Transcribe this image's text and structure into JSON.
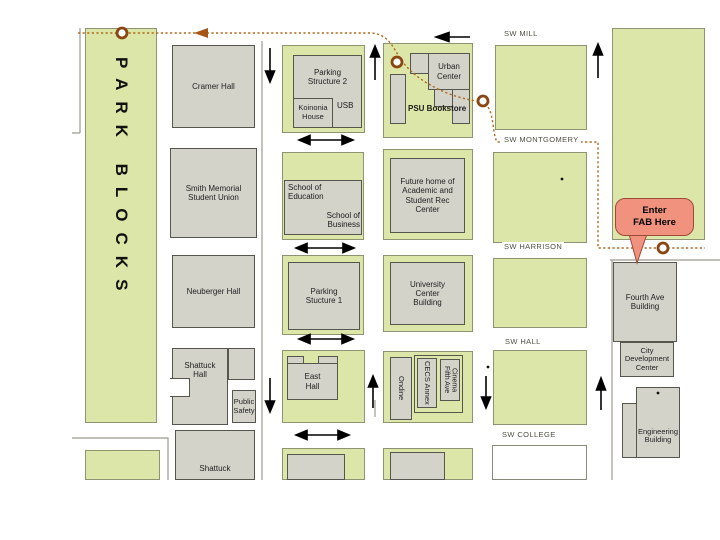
{
  "park_blocks_label": "PARK BLOCKS",
  "streets": {
    "mill": "SW MILL",
    "montgomery": "SW MONTGOMERY",
    "harrison": "SW HARRISON",
    "hall": "SW HALL",
    "college": "SW COLLEGE"
  },
  "buildings": {
    "cramer": "Cramer Hall",
    "smith": "Smith Memorial Student Union",
    "neuberger": "Neuberger Hall",
    "shattuck": "Shattuck Hall",
    "public_safety": "Public Safety",
    "shattuck2": "Shattuck",
    "parking2": "Parking Structure 2",
    "koinonia": "Koinonia House",
    "usb": "USB",
    "school_education": "School of Education",
    "school_business": "School of Business",
    "parking1": "Parking Stucture 1",
    "east": "East Hall",
    "urban": "Urban Center",
    "bookstore": "PSU Bookstore",
    "future_home": "Future home of Academic and Student Rec Center",
    "university_center": "University Center Building",
    "ondine": "Ondine",
    "cecs_annex": "CECS Annex",
    "fifth_ave_cinema": "Fifth Ave Cinema",
    "fourth_ave": "Fourth Ave Building",
    "city_dev": "City Development Center",
    "engineering": "Engineering Building"
  },
  "callout": {
    "line1": "Enter",
    "line2": "FAB Here"
  },
  "colors": {
    "block_green": "#dce6a8",
    "building_gray": "#d3d3ca",
    "route_orange": "#b06a1e",
    "callout_pink": "#f0927e",
    "arrow_black": "#000000"
  }
}
